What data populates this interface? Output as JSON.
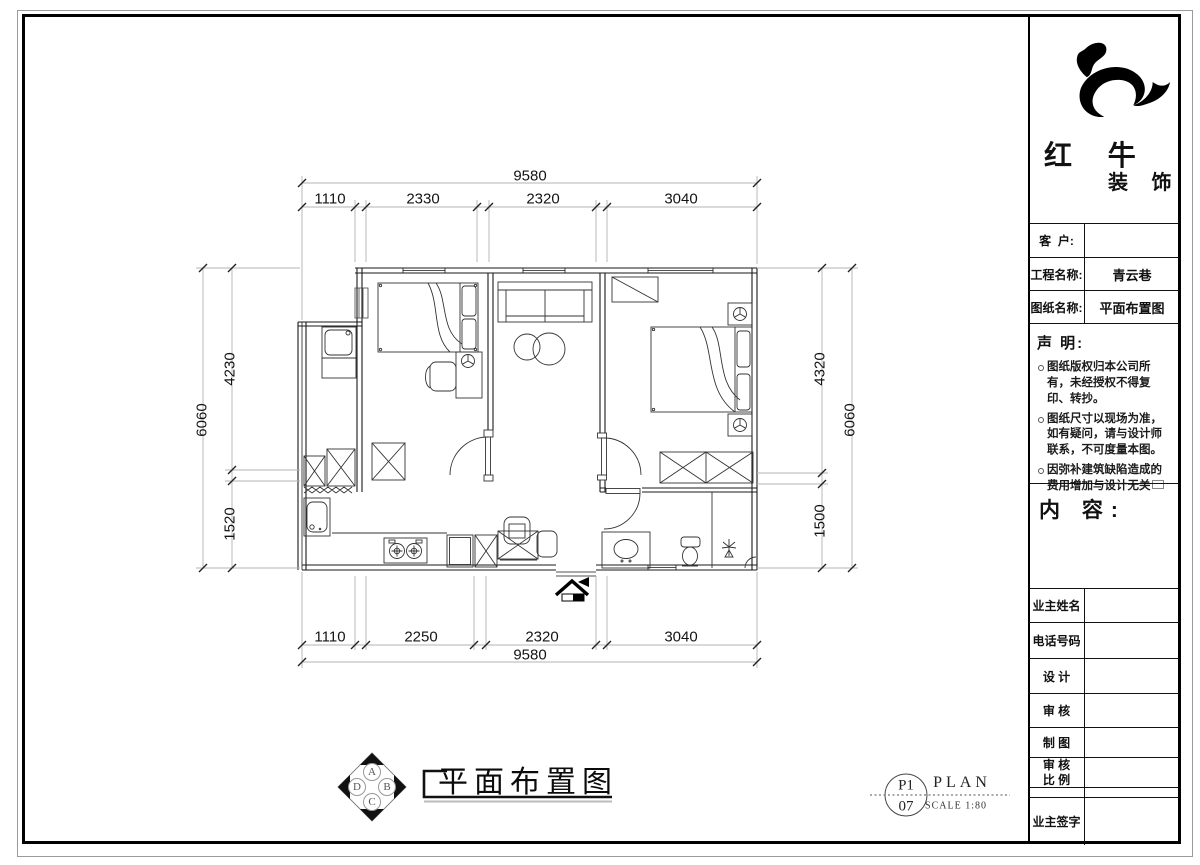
{
  "colors": {
    "line": "#1a1a1a",
    "dim_line": "#b3b3b3"
  },
  "dimensions": {
    "top": {
      "overall": "9580",
      "segments": [
        "1110",
        "2330",
        "2320",
        "3040"
      ]
    },
    "bottom": {
      "overall": "9580",
      "segments": [
        "1110",
        "2250",
        "2320",
        "3040"
      ]
    },
    "left": {
      "overall": "6060",
      "segments": [
        "4230",
        "1520"
      ]
    },
    "right": {
      "overall": "6060",
      "segments": [
        "4320",
        "1500"
      ]
    }
  },
  "caption": {
    "title": "平面布置图"
  },
  "compass": {
    "n": "A",
    "e": "B",
    "s": "C",
    "w": "D"
  },
  "sheet_ref": {
    "number_top": "P1",
    "number_bottom": "07",
    "type": "PLAN",
    "scale": "SCALE 1:80"
  },
  "title_block": {
    "brand": {
      "name_top": "红 牛",
      "name_bottom": "装 饰"
    },
    "info_rows": [
      {
        "label": "客  户:",
        "value": ""
      },
      {
        "label": "工程名称:",
        "value": "青云巷"
      },
      {
        "label": "图纸名称:",
        "value": "平面布置图"
      }
    ],
    "statement": {
      "heading": "声 明:",
      "items": [
        "图纸版权归本公司所有，未经授权不得复印、转抄。",
        "图纸尺寸以现场为准，如有疑问，请与设计师联系，不可度量本图。",
        "因弥补建筑缺陷造成的费用增加与设计无关"
      ]
    },
    "content_heading": "内 容:",
    "sign_rows": [
      {
        "label": "业主姓名"
      },
      {
        "label": "电话号码"
      },
      {
        "label": "设 计"
      },
      {
        "label": "审 核"
      },
      {
        "label": "制 图"
      },
      {
        "label": "审 核",
        "label2": "比 例"
      },
      {
        "label": ""
      },
      {
        "label": "业主签字"
      }
    ]
  }
}
